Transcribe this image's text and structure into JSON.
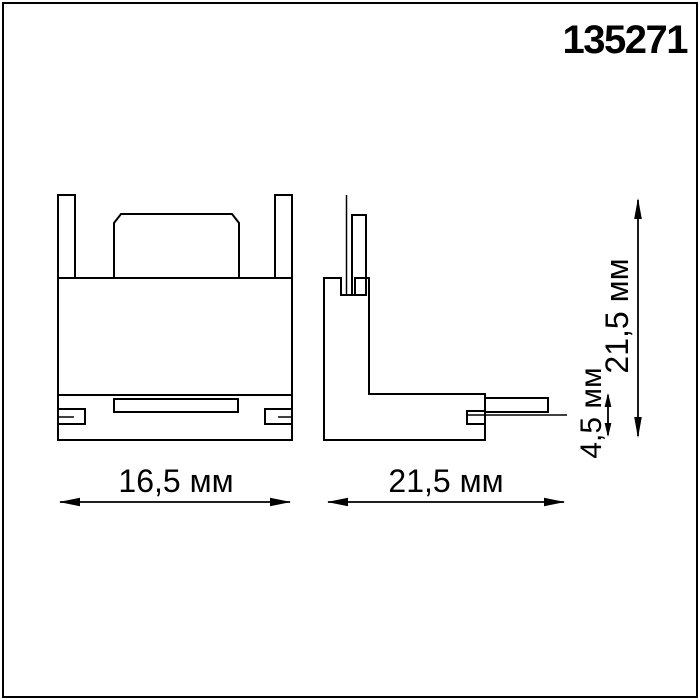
{
  "article_number": "135271",
  "dimensions": {
    "front_width": "16,5 мм",
    "side_width": "21,5 мм",
    "side_height": "21,5 мм",
    "tongue_thickness": "4,5 мм"
  },
  "colors": {
    "line": "#000000",
    "background": "#ffffff"
  }
}
